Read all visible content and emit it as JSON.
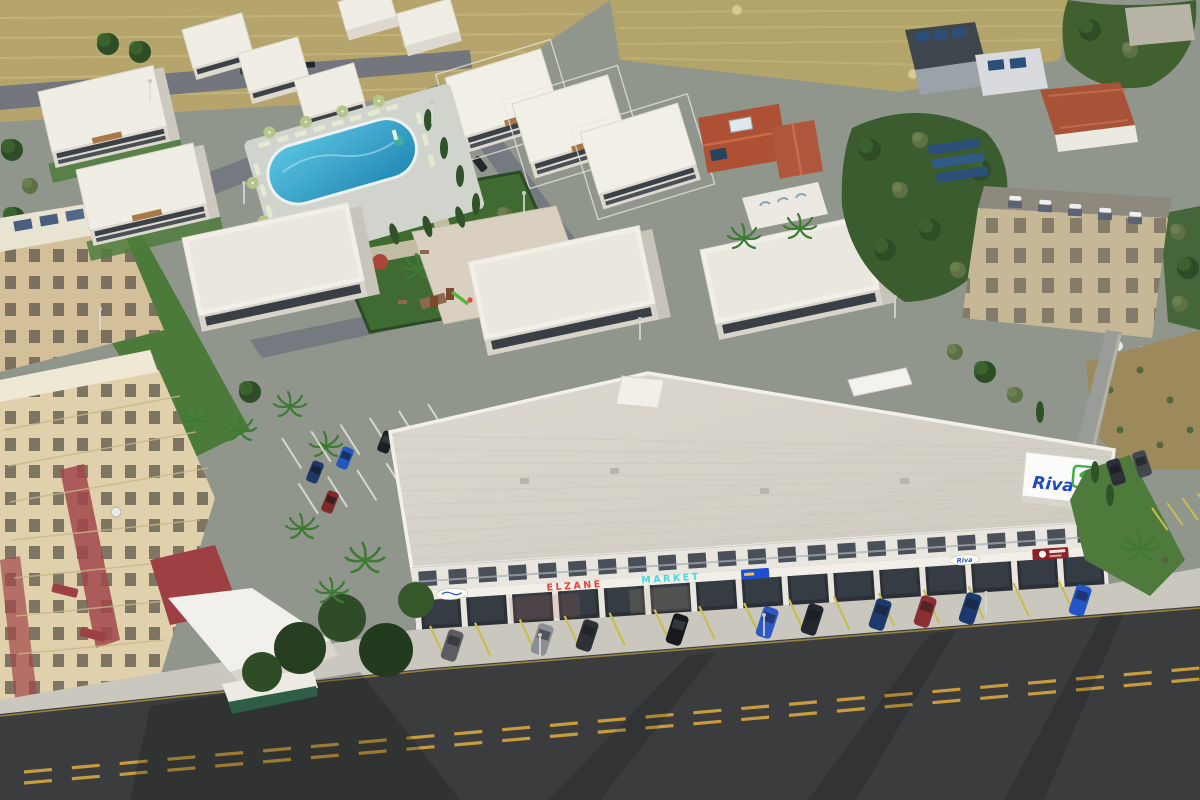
{
  "scene": {
    "alt": "Aerial 3D architectural rendering of the Riva mixed-use development: rows of white modern villas and apartment blocks around a landscaped courtyard with a blue swimming pool, sun loungers, gardens and a colorful playground; a long L-shaped retail building with glass storefronts, shop signs and a rooftop Riva sign; interior and street parking with cars; surrounded by an older beige apartment quarter, red-roofed houses with solar panels, dense trees, dry farm fields and a wide asphalt road with dashed yellow center lines.",
    "features": [
      "swimming-pool",
      "sun-loungers",
      "umbrellas",
      "playground",
      "retail-building",
      "villas",
      "apartment-blocks",
      "parking-lots",
      "main-road",
      "farm-fields",
      "existing-houses",
      "solar-water-heaters",
      "trees",
      "palm-trees"
    ]
  },
  "signage": {
    "brand": "Riva",
    "shops": [
      {
        "label": "ELZANE",
        "color": "#e8433c"
      },
      {
        "label": "MARKET",
        "color": "#45d8e2"
      }
    ]
  },
  "palette": {
    "brand_blue": "#1d49c8",
    "brand_green": "#3fae4a",
    "pool_water": "#3fb0d4",
    "asphalt": "#3b3c3e",
    "road_marking_yellow": "#c89b3c",
    "parking_line_yellow": "#c9bd52",
    "farmland_tan": "#b5a56c",
    "lawn_green": "#4c7a3a",
    "white_building": "#f2efe8",
    "old_town_beige": "#d8c79f",
    "red_tile_roof": "#ad5034"
  }
}
